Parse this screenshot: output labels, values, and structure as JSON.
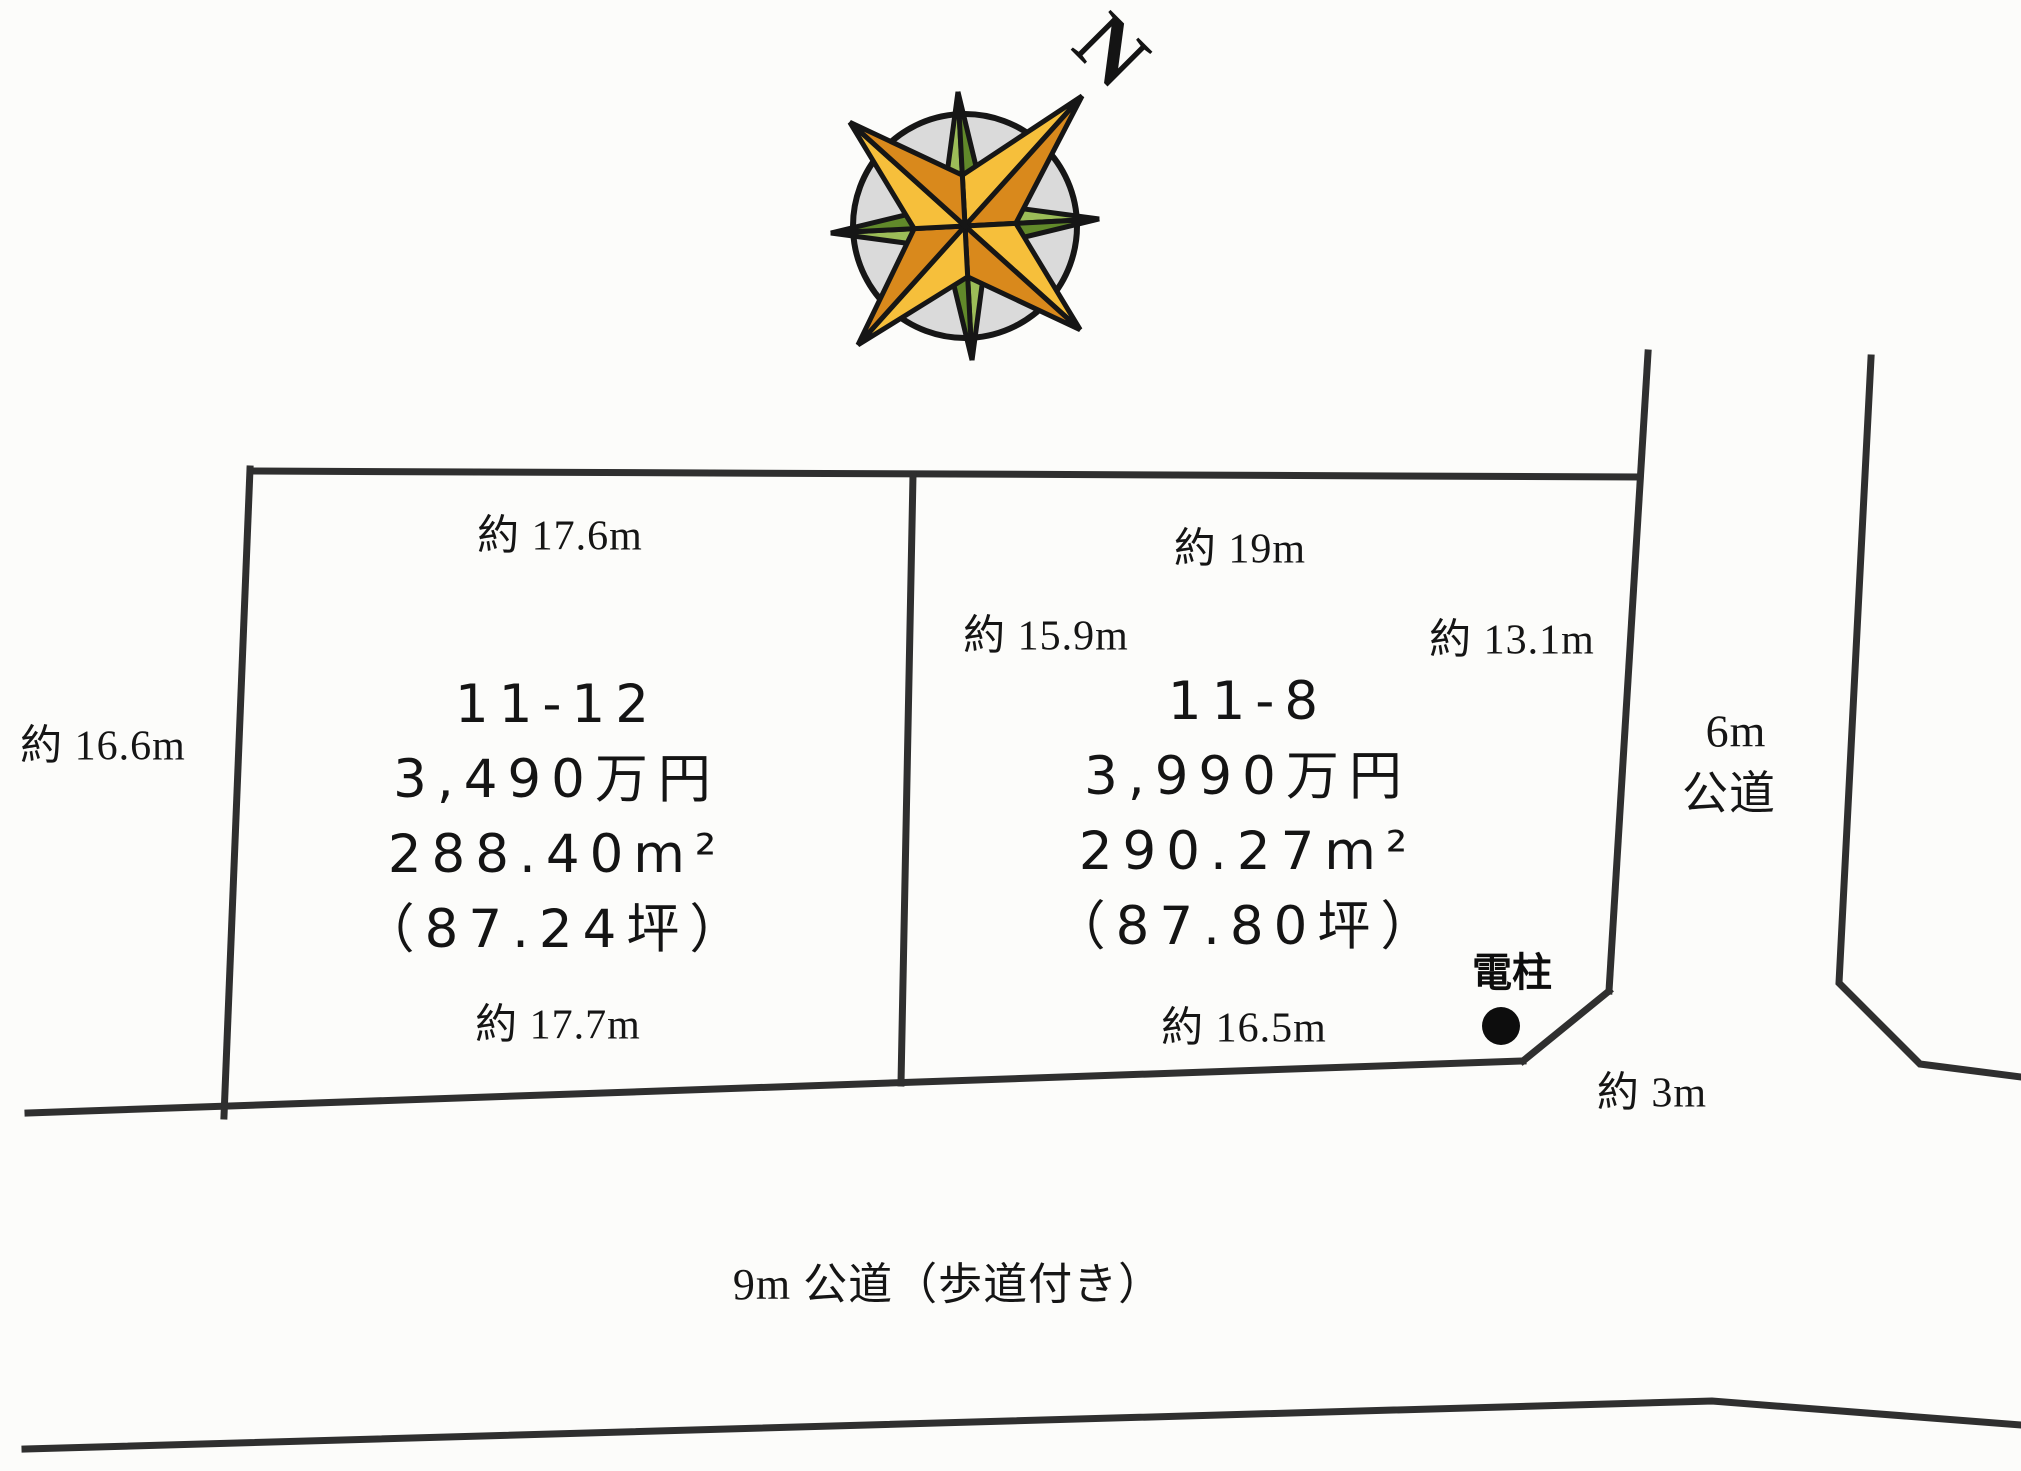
{
  "diagram": {
    "compass": {
      "north_label": "N"
    },
    "plots": [
      {
        "lot_number": "11-12",
        "price": "3,490万円",
        "area_sqm": "288.40m²",
        "area_tsubo": "（87.24坪）",
        "dim_top": "約 17.6m",
        "dim_left": "約 16.6m",
        "dim_bottom": "約 17.7m"
      },
      {
        "lot_number": "11-8",
        "price": "3,990万円",
        "area_sqm": "290.27m²",
        "area_tsubo": "（87.80坪）",
        "dim_top": "約 19m",
        "dim_left": "約 15.9m",
        "dim_right": "約 13.1m",
        "dim_bottom": "約 16.5m",
        "dim_corner": "約 3m"
      }
    ],
    "roads": {
      "east_width": "6m",
      "east_type": "公道",
      "south_label": "9m 公道（歩道付き）"
    },
    "utility_pole_label": "電柱",
    "colors": {
      "line": "#2f2f2f",
      "background": "#fcfcfa",
      "compass_circle": "#dadada",
      "compass_orange_light": "#f6bf3b",
      "compass_orange_dark": "#d9891c",
      "compass_green_light": "#9cbd58",
      "compass_green_dark": "#61892a"
    }
  }
}
